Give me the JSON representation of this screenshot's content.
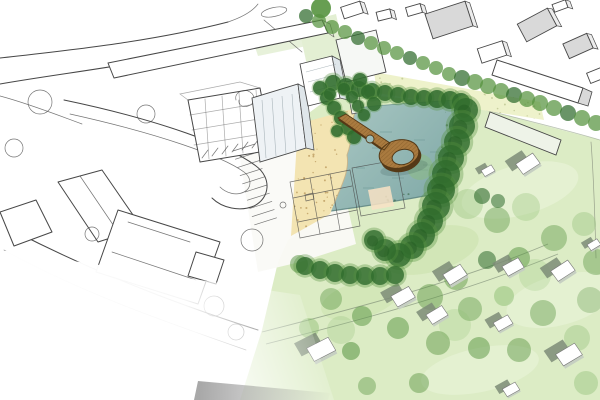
{
  "scene": {
    "subject": "Hand-drawn architectural masterplan aerial sketch: ink line drawing of urban blocks on the west fading to white, blending into a watercolour park with a rectangular bathing pond, sandy beach, looping timber pier bridge, dense tree belts and suburban houses scattered on pale green lawns",
    "palette": {
      "paper": "#ffffff",
      "ink": "#474747",
      "lawn": "#dcecc5",
      "lawn_deep": "#c6e0a6",
      "lawn_light": "#ecf5dd",
      "field": "#eef2cb",
      "field_dot": "#b7c189",
      "pale_strip": "#e3efd3",
      "sand": "#f3e4b2",
      "sand_dot": "#bd9c60",
      "water_light": "#a5c4c0",
      "water_deep": "#7da7a5",
      "water_edge": "#577f7d",
      "marsh": "#3f6b4f",
      "pier": "#a97a3f",
      "pier_dark": "#553916",
      "tree_dark": "#2f6b2d",
      "tree_mid": "#56933f",
      "tree_light": "#8cbd72",
      "house_shadow": "#7d8c77",
      "house_side": "#c6cfc2",
      "roof_gray": "#d9d9d9",
      "building_face": "#eef2f5",
      "building_side": "#dfe6ea",
      "kiosk_peach": "#f8e2c4",
      "fade_gray": "#6f6f6f",
      "path_line": "#7b8a74"
    },
    "trees": {
      "avenue": [
        [
          306,
          16,
          7
        ],
        [
          319,
          21,
          7
        ],
        [
          332,
          27,
          7
        ],
        [
          345,
          32,
          7
        ],
        [
          358,
          38,
          7
        ],
        [
          371,
          43,
          7
        ],
        [
          384,
          48,
          7
        ],
        [
          397,
          53,
          7
        ],
        [
          410,
          58,
          7
        ],
        [
          423,
          63,
          7
        ],
        [
          436,
          68,
          7
        ],
        [
          449,
          74,
          7
        ],
        [
          462,
          78,
          8
        ],
        [
          475,
          82,
          8
        ],
        [
          488,
          86,
          8
        ],
        [
          501,
          91,
          8
        ],
        [
          514,
          95,
          8
        ],
        [
          527,
          99,
          8
        ],
        [
          540,
          103,
          8
        ],
        [
          554,
          108,
          8
        ],
        [
          568,
          113,
          8
        ],
        [
          582,
          118,
          8
        ],
        [
          596,
          123,
          8
        ]
      ],
      "big_single": [
        [
          321,
          8,
          10
        ]
      ],
      "pond_top": [
        [
          333,
          83,
          8
        ],
        [
          346,
          86,
          8
        ],
        [
          359,
          89,
          8
        ],
        [
          372,
          91,
          8
        ],
        [
          385,
          93,
          8
        ],
        [
          398,
          95,
          8
        ],
        [
          411,
          97,
          8
        ],
        [
          424,
          98,
          8
        ],
        [
          437,
          99,
          9
        ],
        [
          450,
          100,
          9
        ],
        [
          461,
          102,
          9
        ]
      ],
      "right_band": [
        [
          466,
          110,
          12
        ],
        [
          462,
          126,
          13
        ],
        [
          457,
          142,
          13
        ],
        [
          451,
          158,
          13
        ],
        [
          446,
          174,
          14
        ],
        [
          441,
          190,
          14
        ],
        [
          436,
          206,
          14
        ],
        [
          430,
          221,
          13
        ],
        [
          422,
          235,
          13
        ],
        [
          412,
          247,
          12
        ],
        [
          399,
          255,
          12
        ],
        [
          385,
          250,
          11
        ],
        [
          374,
          240,
          10
        ]
      ],
      "left_row": [
        [
          320,
          88,
          7
        ],
        [
          327,
          98,
          7
        ],
        [
          334,
          108,
          7
        ],
        [
          341,
          118,
          7
        ],
        [
          348,
          128,
          7
        ],
        [
          354,
          137,
          7
        ],
        [
          337,
          131,
          6
        ],
        [
          330,
          94,
          6
        ],
        [
          344,
          89,
          6
        ],
        [
          352,
          97,
          6
        ],
        [
          358,
          106,
          6
        ],
        [
          364,
          115,
          6
        ],
        [
          360,
          80,
          7
        ],
        [
          368,
          92,
          7
        ],
        [
          374,
          104,
          7
        ]
      ],
      "bush_row": [
        [
          305,
          266,
          9
        ],
        [
          320,
          270,
          9
        ],
        [
          335,
          273,
          9
        ],
        [
          350,
          275,
          9
        ],
        [
          365,
          276,
          9
        ],
        [
          380,
          276,
          9
        ],
        [
          395,
          275,
          9
        ]
      ],
      "lawn_scatter": [
        [
          420,
          167,
          13,
          0.4,
          1
        ],
        [
          443,
          185,
          12,
          0.45,
          0
        ],
        [
          468,
          204,
          15,
          0.35,
          1
        ],
        [
          497,
          220,
          13,
          0.4,
          0
        ],
        [
          526,
          207,
          14,
          0.3,
          1
        ],
        [
          554,
          238,
          13,
          0.4,
          0
        ],
        [
          584,
          224,
          12,
          0.35,
          1
        ],
        [
          596,
          262,
          13,
          0.4,
          0
        ],
        [
          519,
          258,
          11,
          0.5,
          0
        ],
        [
          487,
          260,
          9,
          0.55,
          2
        ],
        [
          456,
          278,
          12,
          0.45,
          0
        ],
        [
          430,
          297,
          13,
          0.45,
          0
        ],
        [
          470,
          309,
          12,
          0.4,
          0
        ],
        [
          504,
          296,
          10,
          0.5,
          1
        ],
        [
          543,
          313,
          13,
          0.4,
          0
        ],
        [
          577,
          338,
          13,
          0.35,
          1
        ],
        [
          519,
          350,
          12,
          0.45,
          0
        ],
        [
          479,
          348,
          11,
          0.5,
          0
        ],
        [
          438,
          343,
          12,
          0.45,
          0
        ],
        [
          398,
          328,
          11,
          0.5,
          0
        ],
        [
          362,
          316,
          10,
          0.5,
          0
        ],
        [
          331,
          299,
          11,
          0.4,
          0
        ],
        [
          309,
          328,
          10,
          0.45,
          1
        ],
        [
          351,
          351,
          9,
          0.55,
          0
        ],
        [
          299,
          264,
          9,
          0.5,
          0
        ],
        [
          586,
          383,
          12,
          0.4,
          1
        ],
        [
          419,
          383,
          10,
          0.45,
          0
        ],
        [
          367,
          386,
          9,
          0.4,
          0
        ],
        [
          341,
          330,
          14,
          0.25,
          1
        ],
        [
          455,
          325,
          16,
          0.22,
          1
        ],
        [
          535,
          275,
          16,
          0.22,
          1
        ],
        [
          590,
          300,
          13,
          0.3,
          0
        ],
        [
          482,
          196,
          8,
          0.6,
          2
        ],
        [
          498,
          201,
          7,
          0.55,
          2
        ]
      ]
    },
    "houses": {
      "suburban": [
        [
          455,
          277,
          21,
          -22
        ],
        [
          513,
          269,
          19,
          -20
        ],
        [
          563,
          273,
          21,
          -24
        ],
        [
          403,
          299,
          21,
          -20
        ],
        [
          437,
          317,
          19,
          -22
        ],
        [
          321,
          352,
          25,
          -18
        ],
        [
          569,
          357,
          23,
          -22
        ],
        [
          503,
          325,
          17,
          -20
        ],
        [
          511,
          391,
          15,
          -20
        ],
        [
          528,
          166,
          21,
          -24
        ],
        [
          488,
          172,
          12,
          -20
        ],
        [
          594,
          246,
          12,
          -22
        ]
      ],
      "sketch_northeast": [
        [
          352,
          10,
          20,
          12,
          -18,
          0
        ],
        [
          384,
          15,
          14,
          9,
          -14,
          0
        ],
        [
          414,
          10,
          15,
          9,
          -16,
          0
        ],
        [
          449,
          20,
          42,
          26,
          -18,
          1
        ],
        [
          492,
          52,
          26,
          15,
          -18,
          0
        ],
        [
          537,
          25,
          34,
          20,
          -28,
          1
        ],
        [
          578,
          46,
          26,
          16,
          -24,
          1
        ],
        [
          560,
          6,
          14,
          8,
          -20,
          0
        ],
        [
          597,
          75,
          18,
          11,
          -22,
          0
        ]
      ]
    },
    "speckles": {
      "sand": {
        "count": 80,
        "seed": 7,
        "color": "sand_dot",
        "rmin": 0.5,
        "rmax": 1.1,
        "opacity": 0.8,
        "bbox": [
          292,
          108,
          64,
          126
        ]
      },
      "field": {
        "count": 70,
        "seed": 13,
        "color": "field_dot",
        "rmin": 0.5,
        "rmax": 1.0,
        "opacity": 0.7,
        "bbox": [
          374,
          72,
          170,
          48
        ]
      },
      "marsh": {
        "count": 90,
        "seed": 29,
        "color": "marsh",
        "rmin": 0.5,
        "rmax": 1.3,
        "opacity": 0.65,
        "bbox": [
          330,
          100,
          128,
          114
        ]
      }
    }
  }
}
